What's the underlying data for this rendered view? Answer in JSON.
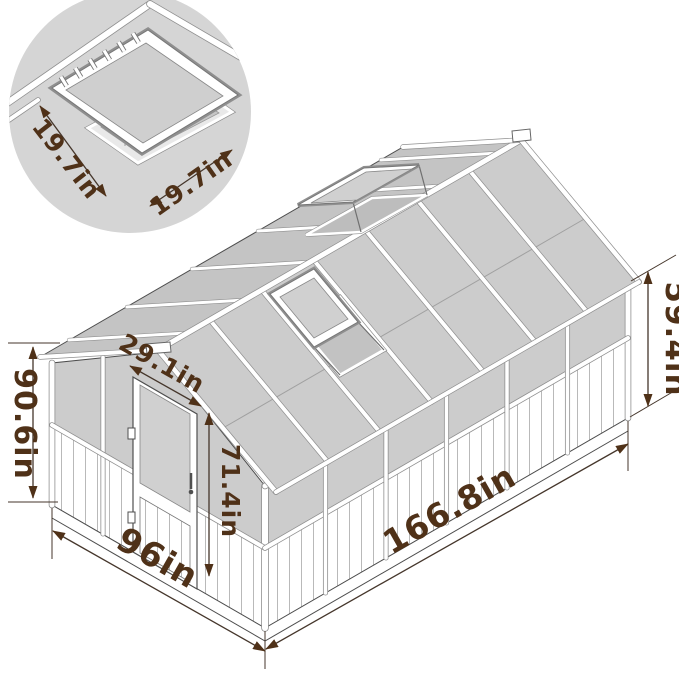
{
  "diagram": {
    "subject": "greenhouse-dimension-drawing",
    "labels": {
      "total_height": "90.6in",
      "eave_height": "59.4in",
      "door_width": "29.1in",
      "door_height": "71.4in",
      "base_length": "166.8in",
      "base_width": "96in",
      "vent_width": "19.7in",
      "vent_depth": "19.7in"
    },
    "colors": {
      "annotation_text": "#4f3118",
      "dimension_line": "#45362b",
      "panel_gray": "#cccccc",
      "structure_line": "#4d4d4d",
      "background": "#ffffff"
    }
  }
}
